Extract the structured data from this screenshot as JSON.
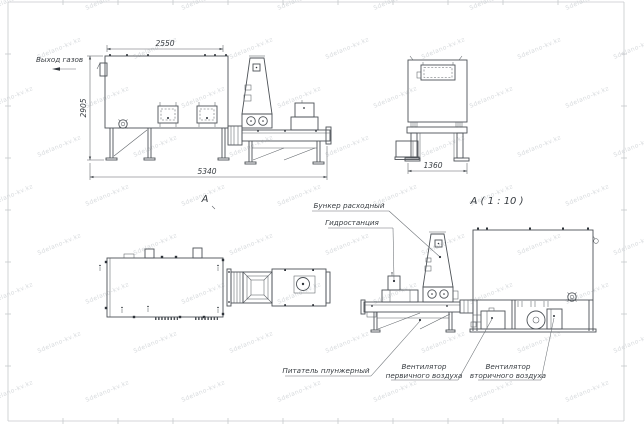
{
  "watermark": {
    "text": "Sdelano-kv.kz"
  },
  "views": {
    "side_main": {
      "label": "А",
      "dim_top": "2550",
      "dim_left": "2905",
      "dim_bottom": "5340",
      "gas_outlet": "Выход газов"
    },
    "front": {
      "label": "А ( 1 : 10 )",
      "dim_bottom": "1360"
    },
    "side_detail": {
      "hopper": "Бункер расходный",
      "hydraulic": "Гидростанция",
      "feeder": "Питатель плунжерный",
      "fan_primary": [
        "Вентилятор",
        "первичного воздуха"
      ],
      "fan_secondary": [
        "Вентилятор",
        "вторичного воздуха"
      ]
    }
  }
}
